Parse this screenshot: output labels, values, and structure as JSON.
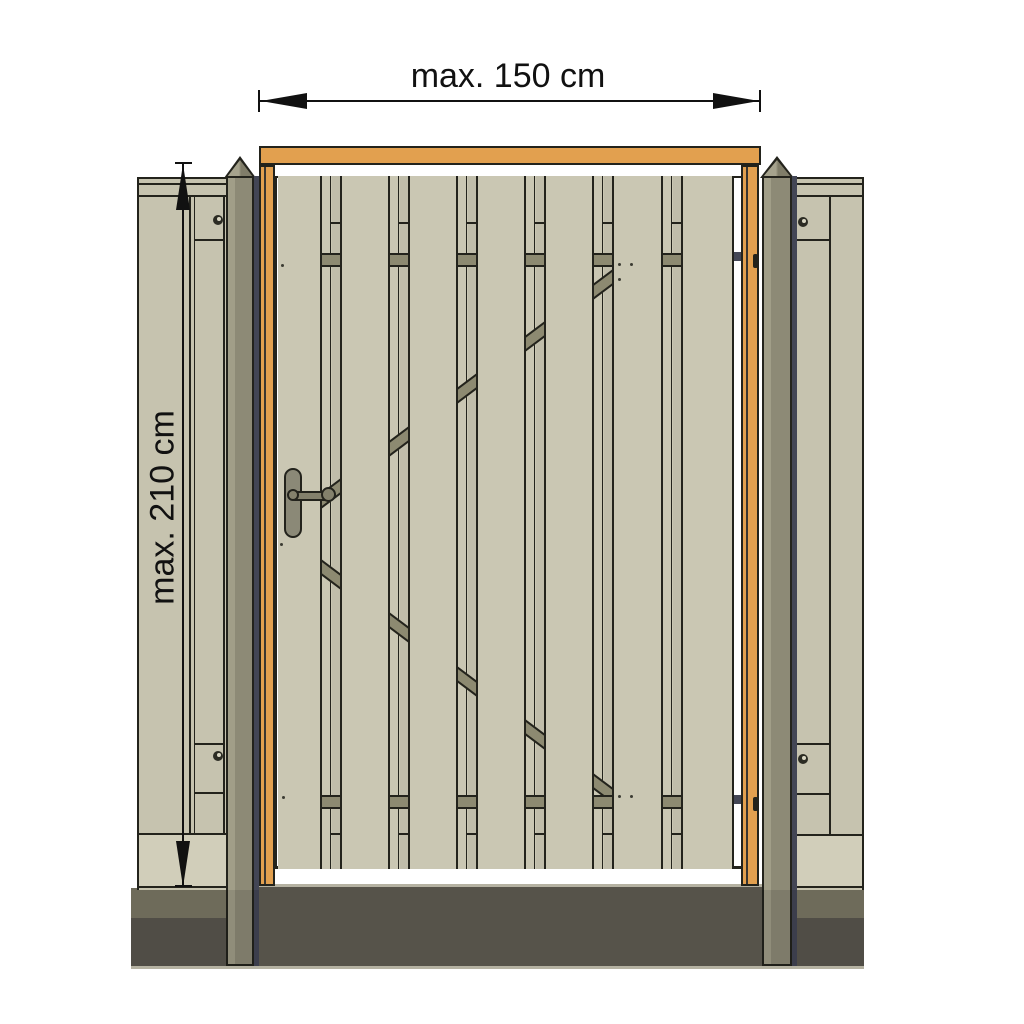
{
  "title": "wooden garden gate dimension drawing",
  "dimensions": {
    "width": {
      "label": "max. 150 cm"
    },
    "height": {
      "label": "max. 210 cm"
    }
  },
  "colors": {
    "text": "#111111",
    "outline": "#23231c",
    "orange": "#e2a04f",
    "orange_shade": "#3a3630",
    "plank": "#cac7b3",
    "gap_dark": "#c0bdaa",
    "rail": "#8d8a71",
    "fence": "#c6c3af",
    "plinth": "#d1ceba",
    "post": "#8d8a76",
    "post_light": "#a19e88",
    "navy": "#434655",
    "ground_center": "#56534a",
    "ground_upper": "#6e6b5a",
    "ground_lower": "#504d46",
    "ground_edge": "#b5b2a2",
    "handle_plate": "#8b8977",
    "handle_bar": "#84816c",
    "screw_dark": "#2b2b23",
    "white": "#ffffff"
  }
}
